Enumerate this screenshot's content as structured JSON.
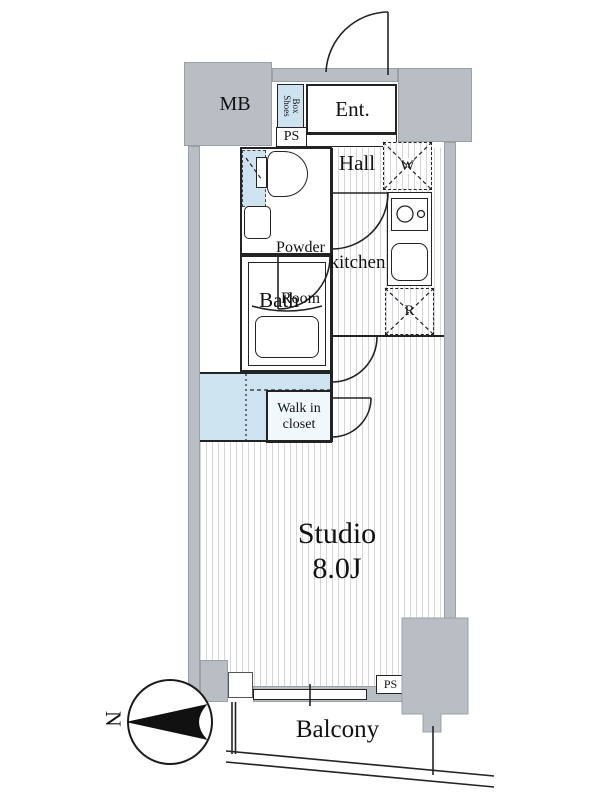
{
  "plan": {
    "rooms": {
      "mb": "MB",
      "shoes_box_line1": "Shoes",
      "shoes_box_line2": "Box",
      "entrance": "Ent.",
      "ps_top": "PS",
      "hall": "Hall",
      "washer": "W",
      "powder_line1": "Powder",
      "powder_line2": "Room",
      "kitchen": "kitchen",
      "bath": "Bath",
      "fridge": "R",
      "closet_line1": "Walk in",
      "closet_line2": "closet",
      "studio_name": "Studio",
      "studio_size": "8.0J",
      "ps_bottom": "PS",
      "balcony": "Balcony",
      "compass_north": "N"
    },
    "colors": {
      "wall": "#b9bec4",
      "highlight": "#cde4f0",
      "stripe": "#d3d6da",
      "line": "#232323"
    }
  }
}
